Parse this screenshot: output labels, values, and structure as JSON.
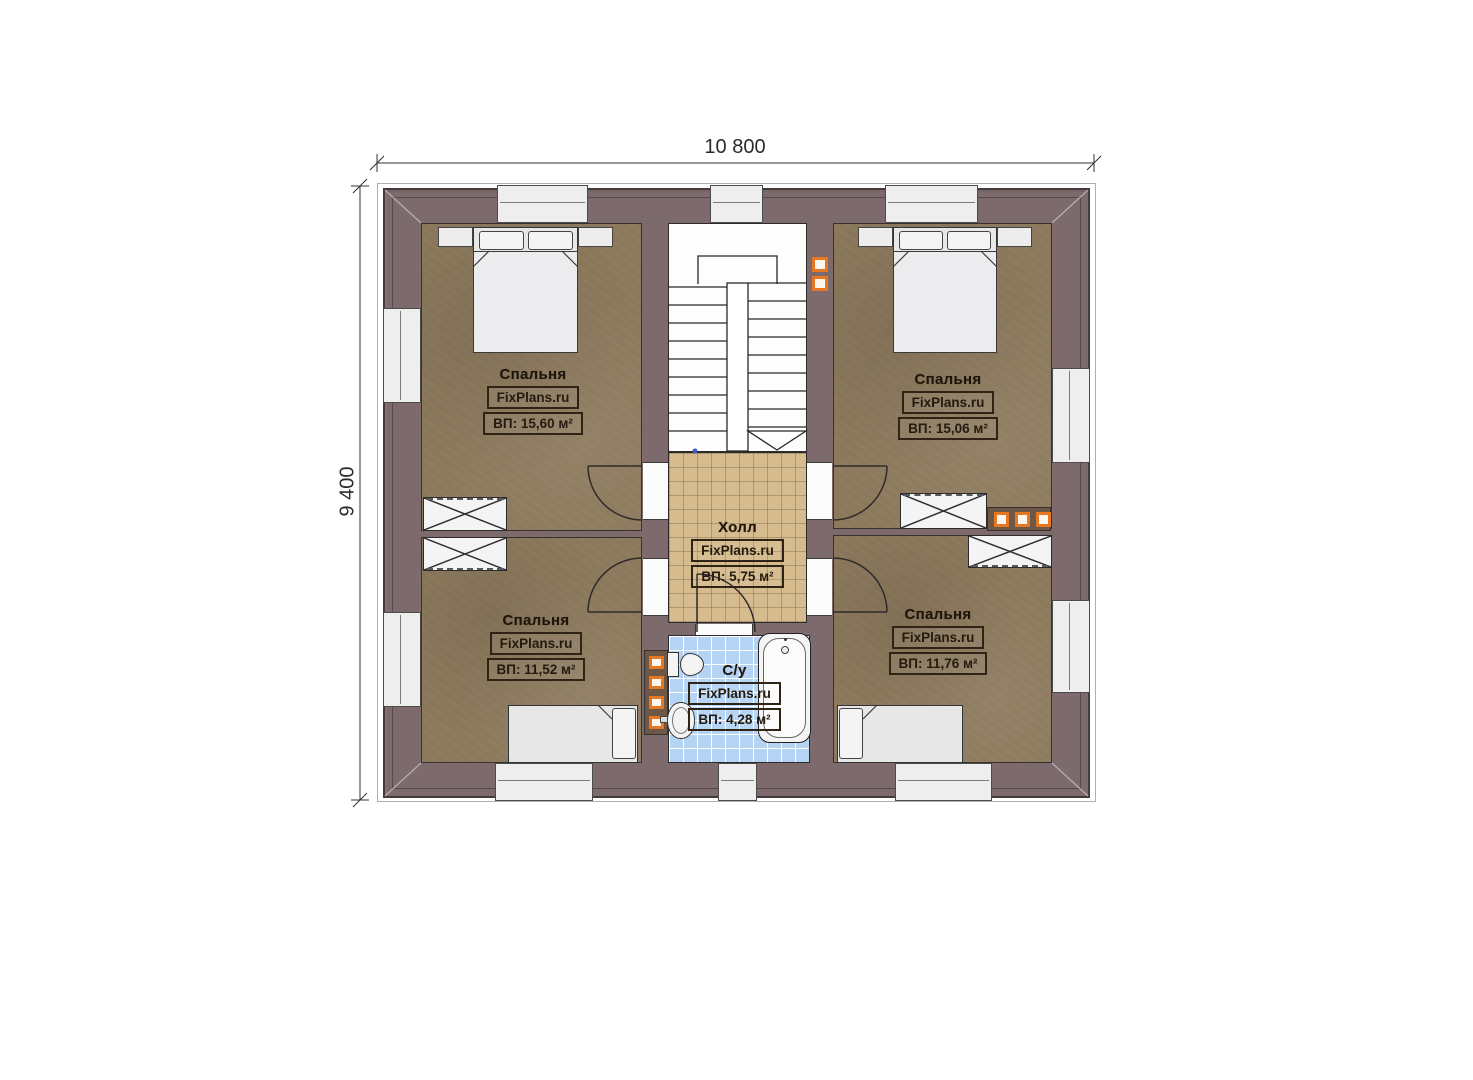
{
  "dimensions": {
    "width": "10 800",
    "height": "9 400"
  },
  "rooms": {
    "bedroom_top_left": {
      "name": "Спальня",
      "brand": "FixPlans.ru",
      "area": "ВП: 15,60 м²"
    },
    "bedroom_top_right": {
      "name": "Спальня",
      "brand": "FixPlans.ru",
      "area": "ВП: 15,06 м²"
    },
    "bedroom_bottom_left": {
      "name": "Спальня",
      "brand": "FixPlans.ru",
      "area": "ВП: 11,52 м²"
    },
    "bedroom_bottom_right": {
      "name": "Спальня",
      "brand": "FixPlans.ru",
      "area": "ВП: 11,76 м²"
    },
    "hall": {
      "name": "Холл",
      "brand": "FixPlans.ru",
      "area": "ВП: 5,75 м²"
    },
    "bathroom": {
      "name": "С/у",
      "brand": "FixPlans.ru",
      "area": "ВП: 4,28 м²"
    }
  },
  "colors": {
    "wall": "#7d6a6c",
    "bedroom_floor": "#8c795c",
    "hall_floor": "#d5bb8d",
    "bathroom_floor": "#b5d3f3",
    "vent_accent": "#e87722"
  }
}
